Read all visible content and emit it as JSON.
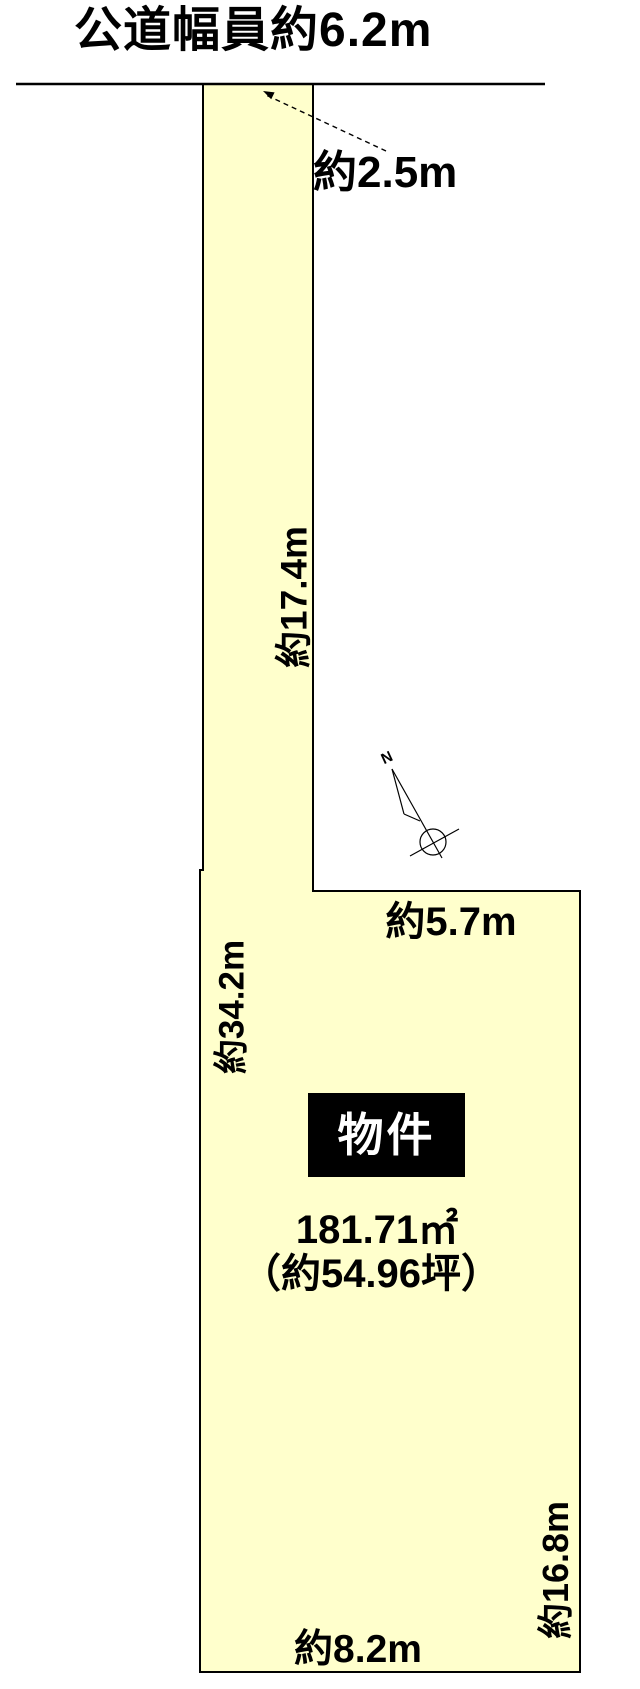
{
  "figure": {
    "road_label": "公道幅員約6.2m",
    "labels": {
      "flag_width": "約2.5m",
      "flag_depth": "約17.4m",
      "inner_top_width": "約5.7m",
      "west_depth": "約34.2m",
      "south_width": "約8.2m",
      "east_depth": "約16.8m"
    },
    "property": {
      "name": "物件",
      "area_sqm": "181.71㎡",
      "area_tsubo": "（約54.96坪）"
    },
    "compass": {
      "north": "N"
    },
    "colors": {
      "parcel_fill": "#FFFFCC",
      "outline": "#000000",
      "property_bg": "#000000",
      "property_fg": "#FFFFFF"
    }
  }
}
